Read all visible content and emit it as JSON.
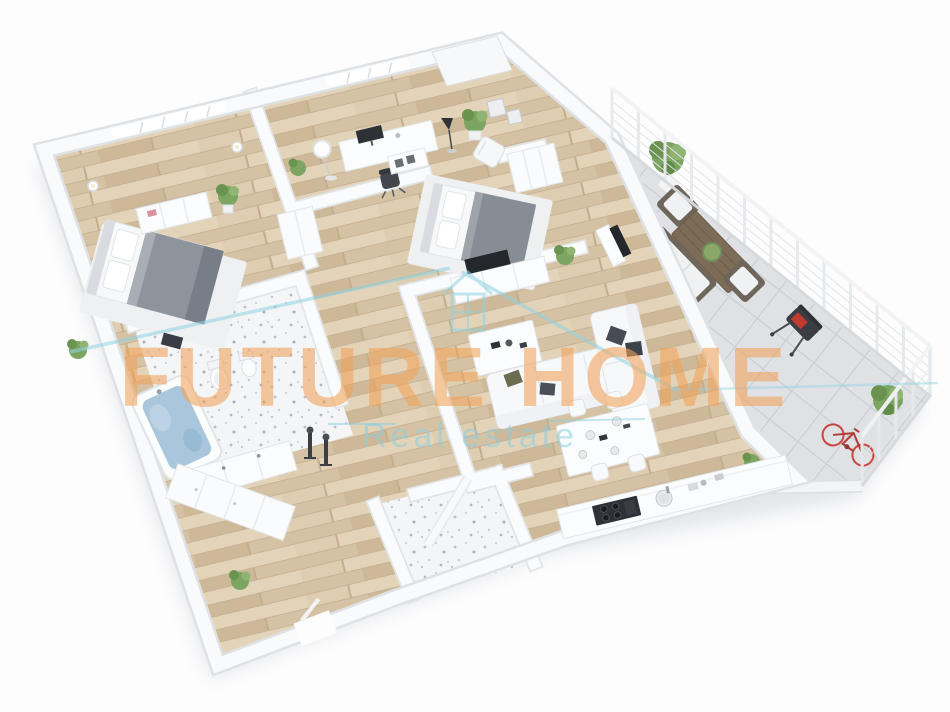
{
  "watermark": {
    "brand": "FUTURE HOME",
    "tagline": "Real estate",
    "brand_color": "#f2a259",
    "tagline_color": "#8ccfe0",
    "logo_icon": "house-outline-icon",
    "logo_color": "#8ed2e2"
  },
  "scene": {
    "type": "3d-floor-plan-render",
    "style": "isometric perspective render, white walls, light oak plank floors",
    "palette": {
      "background": "#fdfdfe",
      "walls": "#fafbfd",
      "wall_shadow": "#e2e5e8",
      "wood_floor": "#dccaae",
      "bath_tile": "#f4f5f7",
      "terrace_tile": "#e0e3e6",
      "bath_water": "#a9c6dc",
      "bed_blanket": "#8e949c",
      "sofa": "#f7f8fa",
      "pillow_dark": "#474c54",
      "outdoor_wood": "#7d6c57",
      "plant_green": "#7da562",
      "grill_flame": "#c23b2e",
      "bicycle_red": "#c9473e"
    },
    "rooms": [
      {
        "name": "master-bedroom",
        "furniture": [
          "double-bed",
          "area-rug",
          "dresser",
          "potted-plants",
          "wall-lamps",
          "windows"
        ]
      },
      {
        "name": "home-office",
        "furniture": [
          "desk",
          "computer-monitor",
          "office-chair",
          "floor-lamp",
          "sideboard",
          "potted-plant"
        ]
      },
      {
        "name": "second-bedroom",
        "furniture": [
          "double-bed",
          "area-rug",
          "media-console",
          "television",
          "wardrobe",
          "lounge-chair",
          "floor-lamp",
          "wall-art",
          "potted-plant"
        ]
      },
      {
        "name": "living-room",
        "furniture": [
          "corner-sofa",
          "throw-pillows",
          "coffee-table",
          "television",
          "potted-plant"
        ]
      },
      {
        "name": "dining-area",
        "furniture": [
          "dining-table",
          "four-chairs",
          "table-settings"
        ]
      },
      {
        "name": "kitchen",
        "furniture": [
          "counter",
          "gas-cooktop",
          "sink"
        ]
      },
      {
        "name": "bathroom",
        "furniture": [
          "bathtub",
          "toilet",
          "bidet",
          "vanity-cabinet",
          "towel-stands"
        ]
      },
      {
        "name": "shower-room",
        "furniture": [
          "shower-partition"
        ]
      },
      {
        "name": "hallway",
        "furniture": [
          "built-in-wardrobes",
          "potted-plant",
          "entrance-door"
        ]
      },
      {
        "name": "terrace",
        "furniture": [
          "outdoor-sofa",
          "outdoor-armchairs",
          "wooden-coffee-table",
          "planter-tree",
          "shrub",
          "bbq-grill",
          "bicycle",
          "glass-railing",
          "parapet-wall"
        ]
      }
    ]
  }
}
